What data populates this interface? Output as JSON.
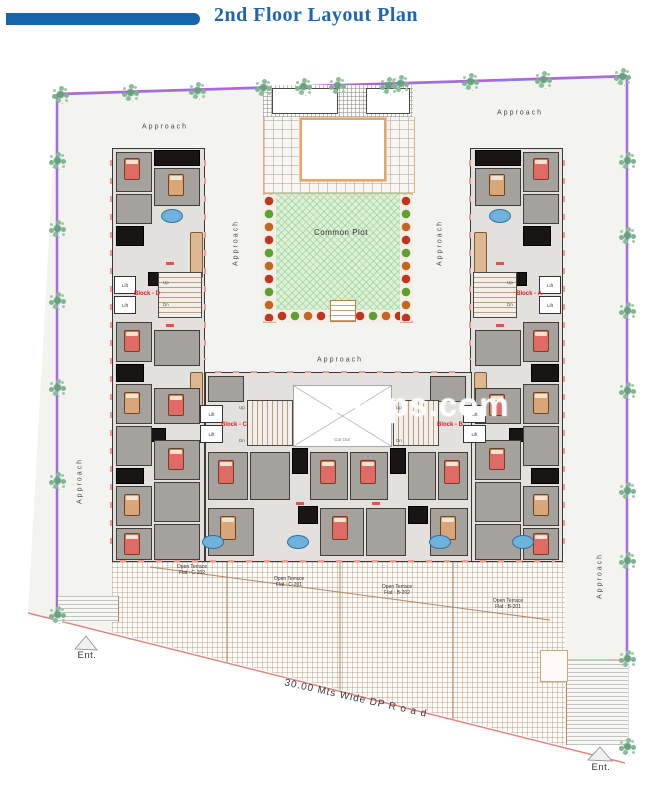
{
  "header": {
    "title": "2nd Floor Layout Plan"
  },
  "watermark": {
    "text": "Props.com"
  },
  "labels": {
    "approach": "Approach",
    "common_plot": "Common Plot",
    "cut_out": "Cut Out",
    "lift": "Lift",
    "up": "Up",
    "dn": "Dn",
    "ent": "Ent.",
    "road": "30.00 Mts Wide DP R o a d"
  },
  "blocks": [
    {
      "id": "D",
      "label": "Block - D"
    },
    {
      "id": "C",
      "label": "Block - C"
    },
    {
      "id": "B",
      "label": "Block - B"
    },
    {
      "id": "A",
      "label": "Block - A"
    }
  ],
  "terraces": [
    {
      "line1": "Open Terrace",
      "line2": "Flat : C-202"
    },
    {
      "line1": "Open Terrace",
      "line2": "Flat : C-201"
    },
    {
      "line1": "Open Terrace",
      "line2": "Flat : B-202"
    },
    {
      "line1": "Open Terrace",
      "line2": "Flat : B-201"
    }
  ],
  "colors": {
    "header_bar": "#1565a8",
    "title_text": "#1e66ae",
    "boundary_outer": "#bb5fd6",
    "boundary_inner": "#7b86e8",
    "road_line": "#e88383",
    "block_label": "#e02020",
    "plot_green": "#def0d8",
    "watermark": "#ffffff"
  }
}
